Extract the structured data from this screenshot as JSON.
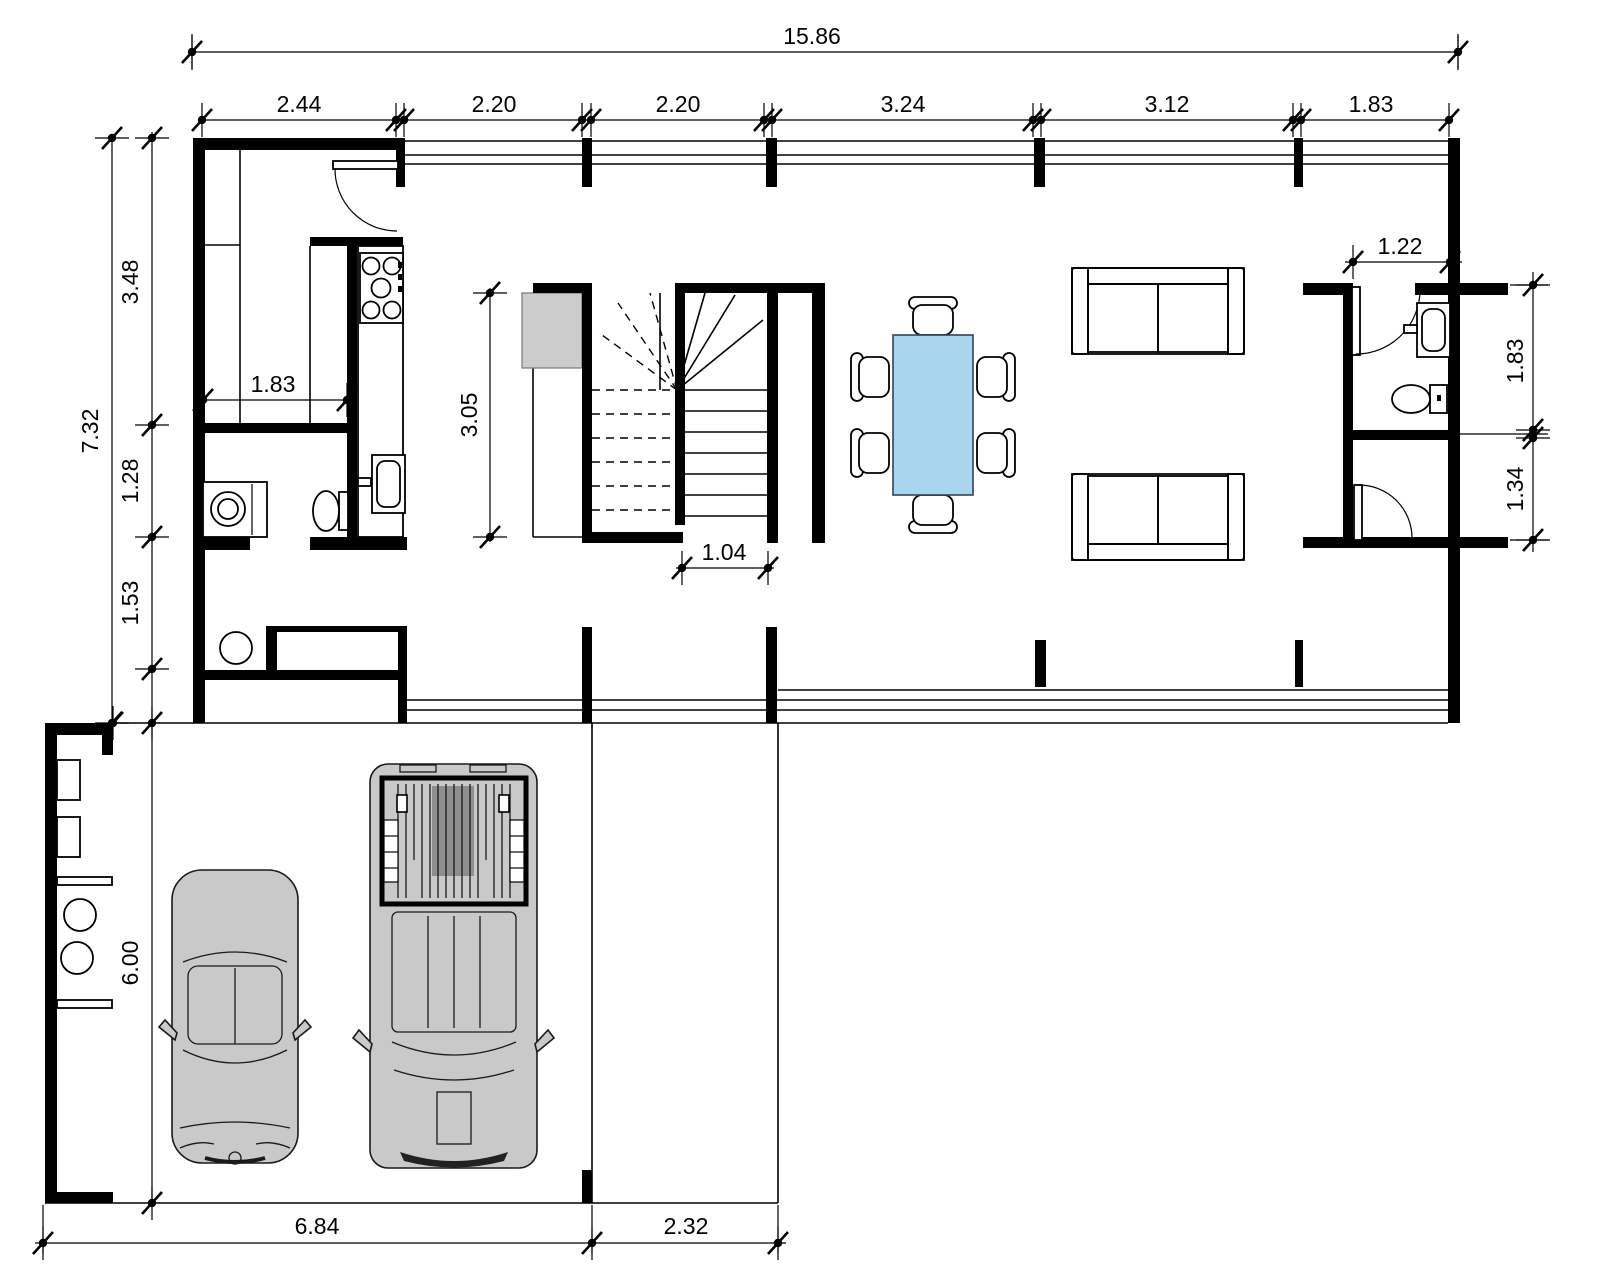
{
  "drawing": {
    "type": "architectural-floor-plan",
    "view": "ground-floor-plan-with-garage",
    "units": "meters"
  },
  "dims": {
    "total_top": "15.86",
    "top": [
      "2.44",
      "2.20",
      "2.20",
      "3.24",
      "3.12",
      "1.83"
    ],
    "left_total": "7.32",
    "left": [
      "3.48",
      "1.28",
      "1.53"
    ],
    "garage_depth": "6.00",
    "kitchen_width": "1.83",
    "stair_well": "3.05",
    "stair_exit": "1.04",
    "bath_niche": "1.22",
    "bath_upper": "1.83",
    "bath_lower": "1.34",
    "garage_width": "6.84",
    "terrace_width": "2.32"
  },
  "colors": {
    "walls": "#000000",
    "dining_table": "#a9d5ef",
    "sofa": "#ededed",
    "stair_landing": "#cccccc",
    "car_body": "#c9c9c9",
    "washer": "#c4c4c4",
    "background": "#ffffff"
  }
}
